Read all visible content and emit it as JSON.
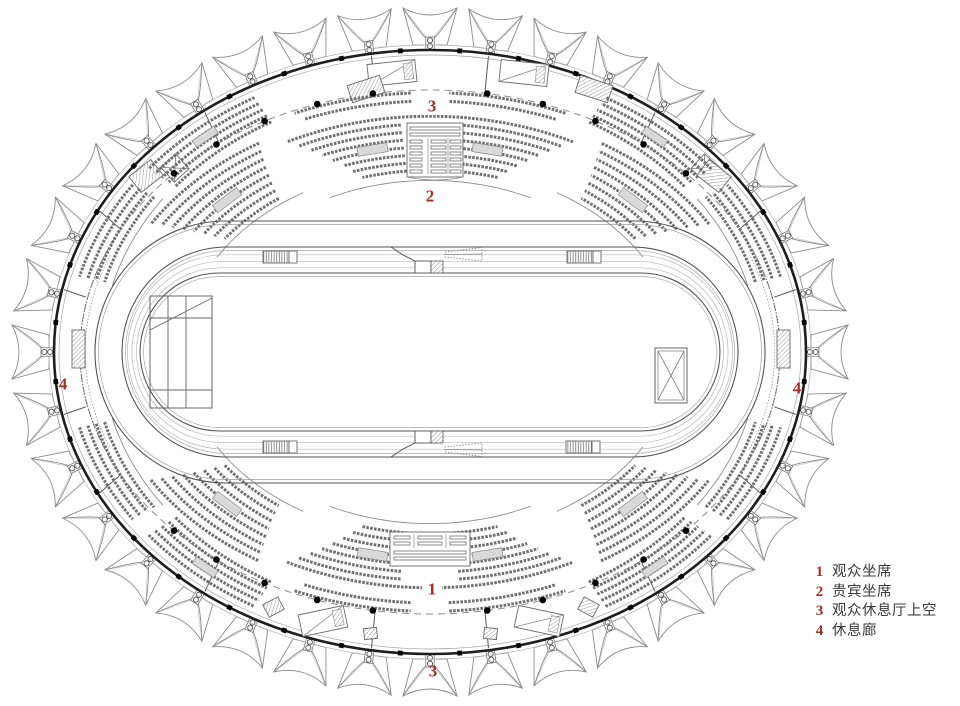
{
  "colors": {
    "accent": "#9e2f2b",
    "ink": "#1e1e1e",
    "line": "#555555",
    "line_light": "#9a9a9a",
    "seat": "#707070",
    "background": "#ffffff"
  },
  "markers": [
    {
      "id": "3-top",
      "label": "3",
      "x": 432,
      "y": 106
    },
    {
      "id": "2-top",
      "label": "2",
      "x": 430,
      "y": 196
    },
    {
      "id": "1-bottom",
      "label": "1",
      "x": 432,
      "y": 589
    },
    {
      "id": "3-bottom",
      "label": "3",
      "x": 433,
      "y": 671
    },
    {
      "id": "4-left",
      "label": "4",
      "x": 63,
      "y": 384
    },
    {
      "id": "4-right",
      "label": "4",
      "x": 797,
      "y": 388
    }
  ],
  "legend": {
    "items": [
      {
        "num": "1",
        "label": "观众坐席"
      },
      {
        "num": "2",
        "label": "贵宾坐席"
      },
      {
        "num": "3",
        "label": "观众休息厅上空"
      },
      {
        "num": "4",
        "label": "休息廊"
      }
    ]
  }
}
